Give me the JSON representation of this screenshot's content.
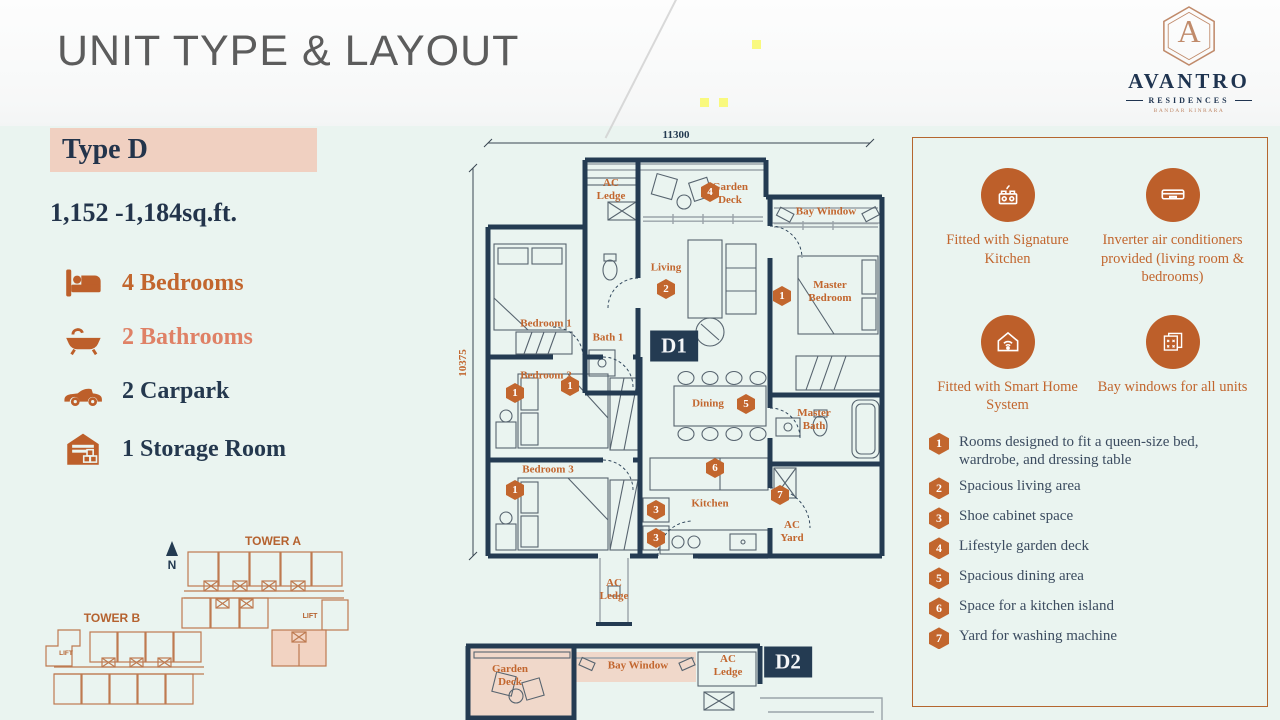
{
  "header": {
    "title": "UNIT TYPE & LAYOUT",
    "logo": {
      "monogram": "A",
      "name": "AVANTRO",
      "sub": "RESIDENCES",
      "tagline": "BANDAR KINRARA"
    }
  },
  "unit": {
    "type_label": "Type D",
    "area": "1,152 -1,184sq.ft.",
    "specs": [
      {
        "icon": "bed-icon",
        "label": "4 Bedrooms",
        "color": "#C2662E"
      },
      {
        "icon": "bathtub-icon",
        "label": "2 Bathrooms",
        "color": "#DF8166"
      },
      {
        "icon": "car-icon",
        "label": "2 Carpark",
        "color": "#24384E"
      },
      {
        "icon": "storage-icon",
        "label": "1 Storage Room",
        "color": "#24384E"
      }
    ]
  },
  "towers": {
    "tower_a_label": "TOWER A",
    "tower_b_label": "TOWER B",
    "lift_label": "LIFT",
    "north_label": "N"
  },
  "floorplan": {
    "dim_width": "11300",
    "dim_height": "10375",
    "plan1_label": "D1",
    "plan2_label": "D2",
    "labels": [
      {
        "t": "AC\nLedge"
      },
      {
        "t": "Garden\nDeck"
      },
      {
        "t": "Bay Window"
      },
      {
        "t": "Bedroom 1"
      },
      {
        "t": "Bath 1"
      },
      {
        "t": "Living"
      },
      {
        "t": "Master\nBedroom"
      },
      {
        "t": "Bedroom 2"
      },
      {
        "t": "Dining"
      },
      {
        "t": "Master\nBath"
      },
      {
        "t": "Bedroom 3"
      },
      {
        "t": "Kitchen"
      },
      {
        "t": "AC\nYard"
      },
      {
        "t": "AC\nLedge"
      },
      {
        "t": "Garden\nDeck"
      },
      {
        "t": "Bay Window"
      },
      {
        "t": "AC\nLedge"
      }
    ],
    "badges": [
      {
        "n": "4"
      },
      {
        "n": "1"
      },
      {
        "n": "2"
      },
      {
        "n": "1"
      },
      {
        "n": "1"
      },
      {
        "n": "5"
      },
      {
        "n": "1"
      },
      {
        "n": "6"
      },
      {
        "n": "7"
      },
      {
        "n": "3"
      },
      {
        "n": "3"
      }
    ]
  },
  "features": {
    "highlights": [
      {
        "icon": "kitchen-icon",
        "text": "Fitted with Signature Kitchen"
      },
      {
        "icon": "aircond-icon",
        "text": "Inverter air conditioners provided (living room & bedrooms)"
      },
      {
        "icon": "smart-home-icon",
        "text": "Fitted with Smart Home System"
      },
      {
        "icon": "bay-window-icon",
        "text": "Bay windows for all units"
      }
    ],
    "legend": [
      {
        "num": "1",
        "text": "Rooms designed to fit a queen-size bed, wardrobe, and dressing table"
      },
      {
        "num": "2",
        "text": "Spacious living area"
      },
      {
        "num": "3",
        "text": "Shoe cabinet space"
      },
      {
        "num": "4",
        "text": "Lifestyle garden deck"
      },
      {
        "num": "5",
        "text": "Spacious dining area"
      },
      {
        "num": "6",
        "text": "Space for a kitchen island"
      },
      {
        "num": "7",
        "text": "Yard for washing machine"
      }
    ]
  },
  "colors": {
    "background_mint": "#EAF4F0",
    "header_bg": "#FBFBFB",
    "title_gray": "#5c5c5c",
    "navy": "#243B52",
    "accent_orange": "#C2662E",
    "icon_orange": "#BD5F2A",
    "salmon_text": "#DF8166",
    "highlight_pink": "#F0D0C1",
    "plan_fill_pink": "#F0D8CA",
    "panel_border": "#B5662F",
    "logo_copper": "#C08A6A",
    "yellow_accent": "#F9F97E"
  }
}
